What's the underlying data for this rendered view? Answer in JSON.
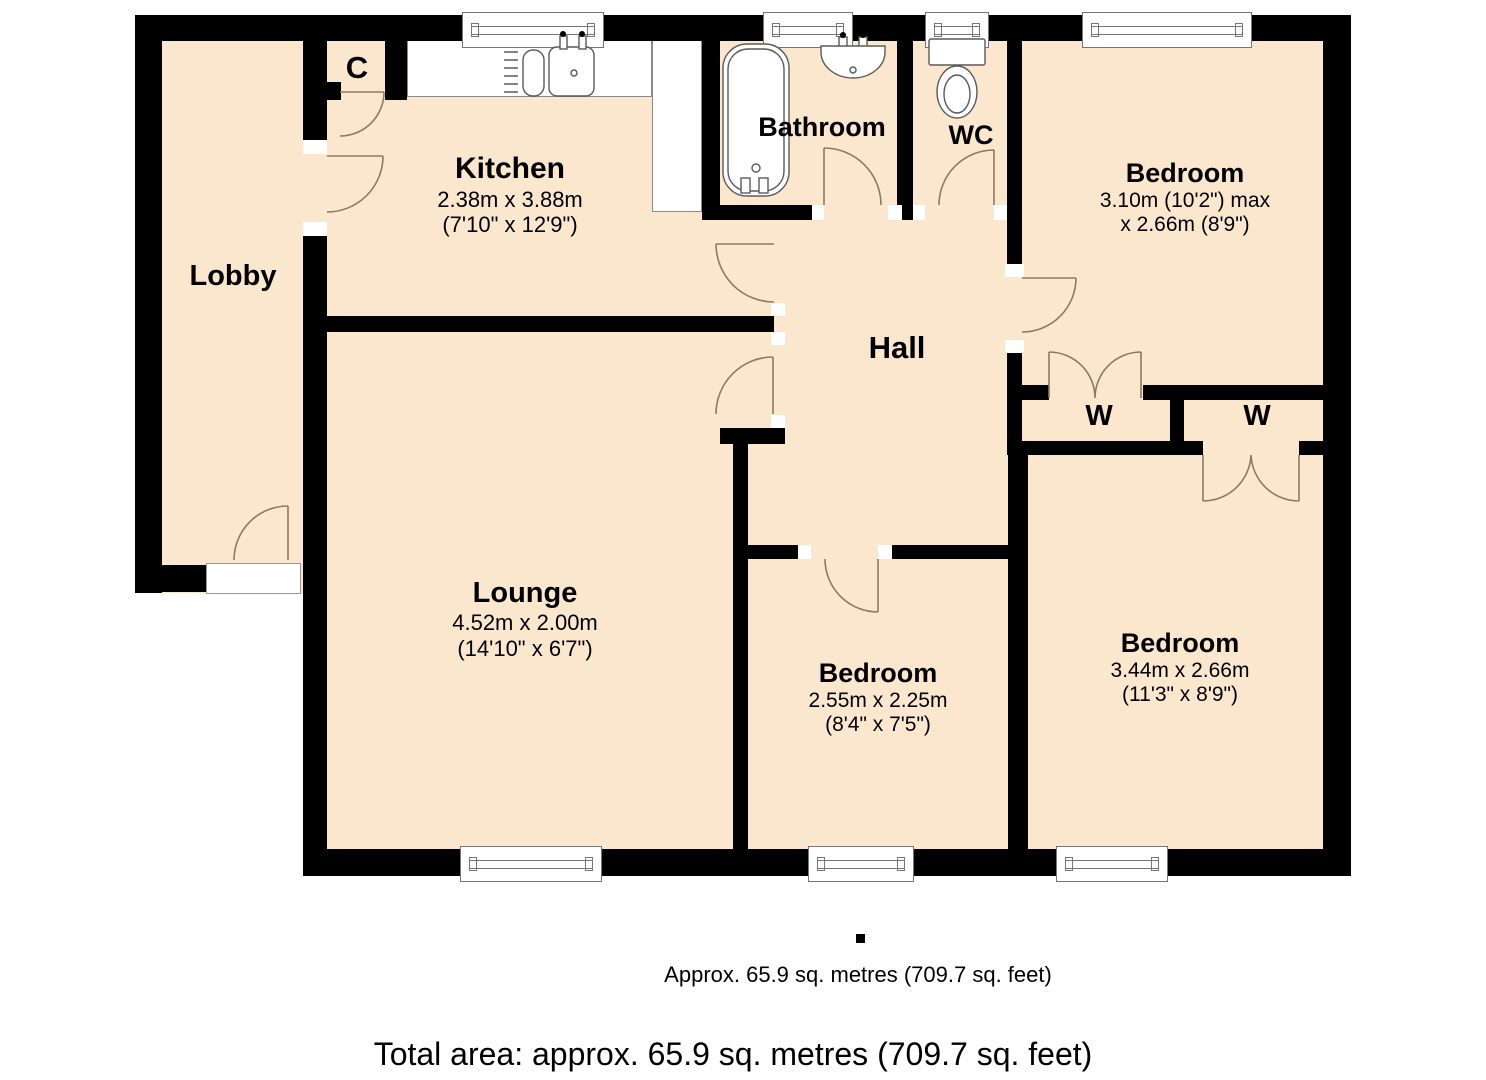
{
  "colors": {
    "floor_fill": "#fae7cd",
    "wall": "#000000",
    "door_line": "#8a7a66",
    "fixture_line": "#5a5a5a"
  },
  "rooms": {
    "lobby": {
      "name": "Lobby"
    },
    "closet_c": {
      "name": "C"
    },
    "kitchen": {
      "name": "Kitchen",
      "metric": "2.38m x 3.88m",
      "imperial": "(7'10\" x 12'9\")"
    },
    "bathroom": {
      "name": "Bathroom"
    },
    "wc": {
      "name": "WC"
    },
    "bedroom_top_right": {
      "name": "Bedroom",
      "metric": "3.10m (10'2\") max",
      "imperial": "x 2.66m (8'9\")"
    },
    "hall": {
      "name": "Hall"
    },
    "wardrobe_left": {
      "name": "W"
    },
    "wardrobe_right": {
      "name": "W"
    },
    "lounge": {
      "name": "Lounge",
      "metric": "4.52m x 2.00m",
      "imperial": "(14'10\" x 6'7\")"
    },
    "bedroom_middle": {
      "name": "Bedroom",
      "metric": "2.55m x 2.25m",
      "imperial": "(8'4\" x 7'5\")"
    },
    "bedroom_bottom_right": {
      "name": "Bedroom",
      "metric": "3.44m x 2.66m",
      "imperial": "(11'3\" x 8'9\")"
    }
  },
  "captions": {
    "area_note": "Approx. 65.9 sq. metres (709.7 sq. feet)",
    "total_area": "Total area: approx. 65.9 sq. metres (709.7 sq. feet)"
  }
}
